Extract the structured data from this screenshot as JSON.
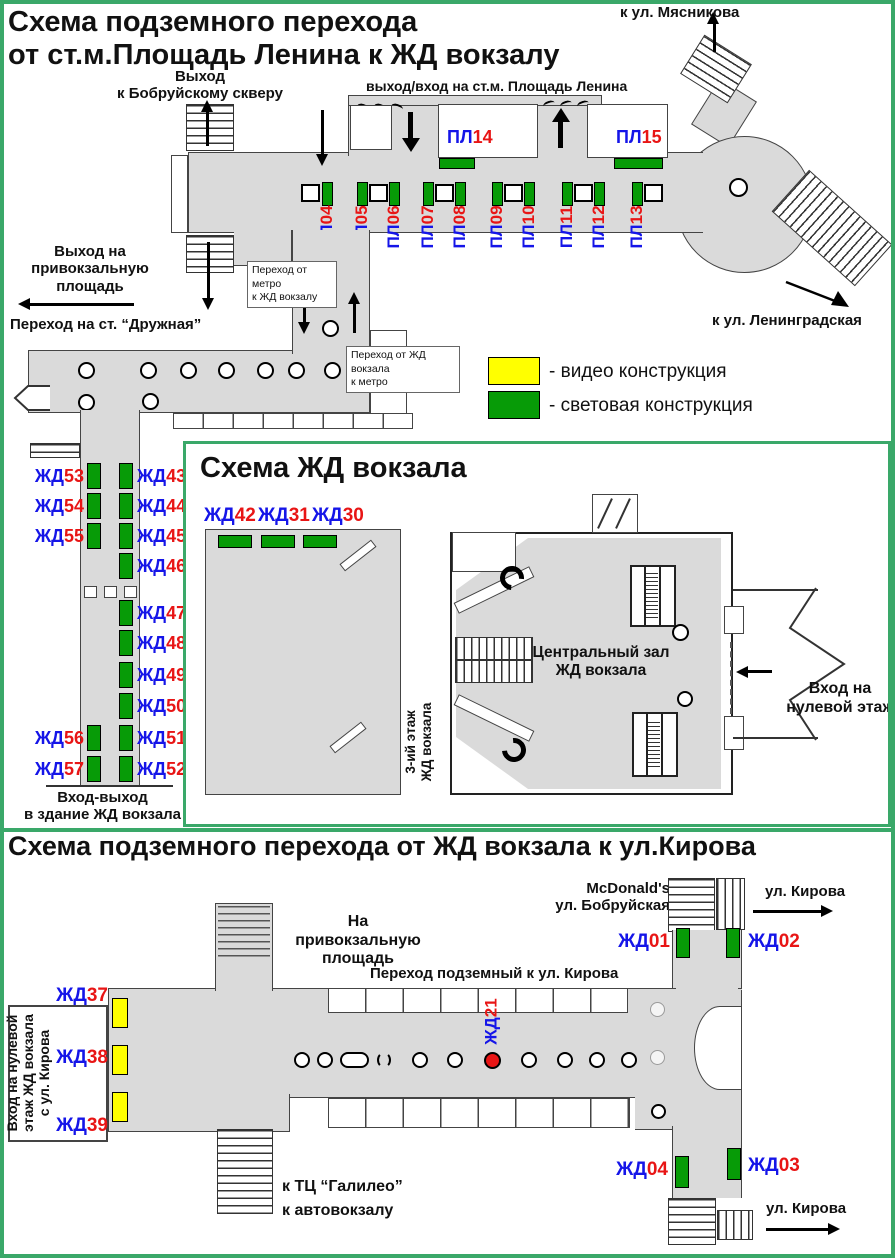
{
  "colors": {
    "frame_green": "#3aa869",
    "floor_gray": "#dadada",
    "light_construction_green": "#079b07",
    "video_construction_yellow": "#ffff00",
    "sign_prefix_blue": "#1515e8",
    "sign_number_red": "#e81515",
    "marker_red": "#e81515"
  },
  "legend": {
    "video": "- видео конструкция",
    "light": "- световая конструкция"
  },
  "metro_section": {
    "title": "Схема подземного перехода\nот ст.м.Площадь Ленина к ЖД вокзалу",
    "bobruysky_exit": "Выход\nк Бобруйскому скверу",
    "metro_entrance": "выход/вход на ст.м. Площадь Ленина",
    "myasnikova": "к ул. Мясникова",
    "leningradskaya": "к ул. Ленинградская",
    "square_exit": "Выход на\nпривокзальную площадь",
    "druzhnaya": "Переход на ст. “Дружная”",
    "metro_to_rail_box": "Переход от метро\nк ЖД вокзалу",
    "rail_to_metro_box": "Переход от ЖД вокзала\nк метро",
    "signs_row": [
      {
        "p": "ПЛ",
        "n": "04"
      },
      {
        "p": "ПЛ",
        "n": "05"
      },
      {
        "p": "ПЛ",
        "n": "06"
      },
      {
        "p": "ПЛ",
        "n": "07"
      },
      {
        "p": "ПЛ",
        "n": "08"
      },
      {
        "p": "ПЛ",
        "n": "09"
      },
      {
        "p": "ПЛ",
        "n": "10"
      },
      {
        "p": "ПЛ",
        "n": "11"
      },
      {
        "p": "ПЛ",
        "n": "12"
      },
      {
        "p": "ПЛ",
        "n": "13"
      }
    ],
    "sign_14": {
      "p": "ПЛ",
      "n": "14"
    },
    "sign_15": {
      "p": "ПЛ",
      "n": "15"
    }
  },
  "station_section": {
    "title": "Схема ЖД вокзала",
    "top_signs": [
      {
        "p": "ЖД",
        "n": "42"
      },
      {
        "p": "ЖД",
        "n": "31"
      },
      {
        "p": "ЖД",
        "n": "30"
      }
    ],
    "central_hall": "Центральный зал\nЖД вокзала",
    "third_floor": "3-ий этаж\nЖД вокзала",
    "zero_floor": "Вход на\nнулевой этаж",
    "station_door": "Вход-выход\nв здание ЖД вокзала",
    "left_signs": [
      {
        "p": "ЖД",
        "n": "53"
      },
      {
        "p": "ЖД",
        "n": "54"
      },
      {
        "p": "ЖД",
        "n": "55"
      },
      {
        "p": "ЖД",
        "n": "56"
      },
      {
        "p": "ЖД",
        "n": "57"
      }
    ],
    "right_signs": [
      {
        "p": "ЖД",
        "n": "43"
      },
      {
        "p": "ЖД",
        "n": "44"
      },
      {
        "p": "ЖД",
        "n": "45"
      },
      {
        "p": "ЖД",
        "n": "46"
      },
      {
        "p": "ЖД",
        "n": "47"
      },
      {
        "p": "ЖД",
        "n": "48"
      },
      {
        "p": "ЖД",
        "n": "49"
      },
      {
        "p": "ЖД",
        "n": "50"
      },
      {
        "p": "ЖД",
        "n": "51"
      },
      {
        "p": "ЖД",
        "n": "52"
      }
    ]
  },
  "kirova_section": {
    "title": "Схема подземного перехода от ЖД вокзала к ул.Кирова",
    "mcdonalds": "McDonald's\nул. Бобруйская",
    "kirova_top": "ул. Кирова",
    "kirova_bottom": "ул. Кирова",
    "square": "На привокзальную\nплощадь",
    "underpass": "Переход подземный к ул. Кирова",
    "galileo": "к ТЦ “Галилео”\nк автовокзалу",
    "zero_entrance": "Вход на нулевой\nэтаж ЖД вокзала\nс ул. Кирова",
    "sign_01": {
      "p": "ЖД",
      "n": "01"
    },
    "sign_02": {
      "p": "ЖД",
      "n": "02"
    },
    "sign_03": {
      "p": "ЖД",
      "n": "03"
    },
    "sign_04": {
      "p": "ЖД",
      "n": "04"
    },
    "sign_21": {
      "p": "ЖД",
      "n": "21"
    },
    "sign_37": {
      "p": "ЖД",
      "n": "37"
    },
    "sign_38": {
      "p": "ЖД",
      "n": "38"
    },
    "sign_39": {
      "p": "ЖД",
      "n": "39"
    }
  }
}
